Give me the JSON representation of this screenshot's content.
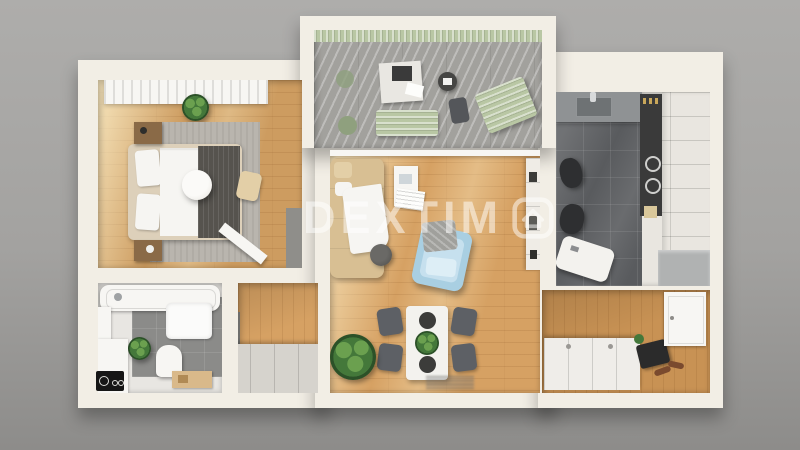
{
  "image": {
    "kind": "3d-apartment-floor-plan-render",
    "width": 800,
    "height": 450
  },
  "watermark": {
    "text": "DEXTIM",
    "trailing_icon": "house-in-rounded-square-icon",
    "full_brand": "DEXTIMO"
  },
  "corner_badge": {
    "icon": "circles-logo-badge"
  },
  "palette": {
    "bg_top": "#aeadab",
    "bg_mid": "#a3a2a0",
    "bg_bottom": "#8d8c8a",
    "wall": "#f2eee5",
    "wall_edge": "#d9d4c9",
    "wood": "#d6a163",
    "wood_entry": "#c89254",
    "rug": "#b9b5ae",
    "bed_frame": "#ddd0ba",
    "bed_white": "#f6f5f2",
    "throw_dark": "#56534e",
    "nightstand": "#8a6a47",
    "tile_balcony": "#a2a19d",
    "sage": "#b9c7a4",
    "sage_dark": "#8fa07e",
    "tile_kitchen": "#595b5e",
    "counter": "#8f9294",
    "cabinet_white": "#e9e6e0",
    "appliance_dark": "#3a3a3a",
    "stool_dark": "#2e2f31",
    "bath_tile": "#8b8b89",
    "fixture_white": "#f7f6f3",
    "mat_white": "#fbfbfa",
    "grey_cabinet": "#d6d3cd",
    "grey_panel": "#8f8e8a",
    "sofa": "#d8bf93",
    "sofa_light": "#e3cfa7",
    "armchair": "#a9cfe2",
    "armchair_light": "#c6e0ee",
    "chair_dark": "#5d6065",
    "table_white": "#f3f2ee",
    "plant": "#44783a",
    "plant_light": "#6ba04f",
    "plant_dark": "#2c5128",
    "bag_dark": "#2b2b2b",
    "shoe_brown": "#7a4a2e",
    "watermark": "rgba(255,255,255,0.50)",
    "badge_bg": "#161616"
  },
  "rooms": [
    {
      "id": "balcony",
      "items": [
        "pergola-slats",
        "garden-bench",
        "picnic-blanket",
        "serving-tray",
        "magazine",
        "round-side-table",
        "garden-chair",
        "lounge-chair",
        "small-green-table"
      ]
    },
    {
      "id": "bedroom",
      "items": [
        "window-curtains",
        "potted-plant",
        "area-rug",
        "double-bed",
        "pillows",
        "dark-throw-blanket",
        "pendant-ball-lamp",
        "nightstand",
        "nightstand",
        "floor-cushion",
        "wardrobe-panel",
        "open-door"
      ]
    },
    {
      "id": "bathroom",
      "items": [
        "bathtub",
        "window",
        "tile-wall",
        "fluffy-bath-mat",
        "toilet",
        "potted-plant",
        "vanity-bench",
        "wooden-tray"
      ]
    },
    {
      "id": "hallway",
      "items": [
        "low-wardrobe-cabinet",
        "dark-wall-panel"
      ]
    },
    {
      "id": "living-room",
      "items": [
        "balcony-door",
        "beige-sofa",
        "white-throw",
        "side-table",
        "magazines",
        "round-pouf",
        "blue-armchair",
        "dining-table",
        "dining-chairs",
        "table-plant",
        "bowls",
        "large-potted-plant",
        "book-shelf-strip",
        "wall-marks"
      ]
    },
    {
      "id": "kitchen",
      "items": [
        "counter-with-sink",
        "faucet",
        "spice-jars",
        "appliance-column",
        "cooktop-knobs",
        "tall-white-cabinets",
        "base-grey-cabinet",
        "bar-stool",
        "bar-stool",
        "white-table"
      ]
    },
    {
      "id": "entry-hall",
      "items": [
        "white-sideboard",
        "bag",
        "shoes",
        "entry-door-panel",
        "small-plant"
      ]
    }
  ]
}
